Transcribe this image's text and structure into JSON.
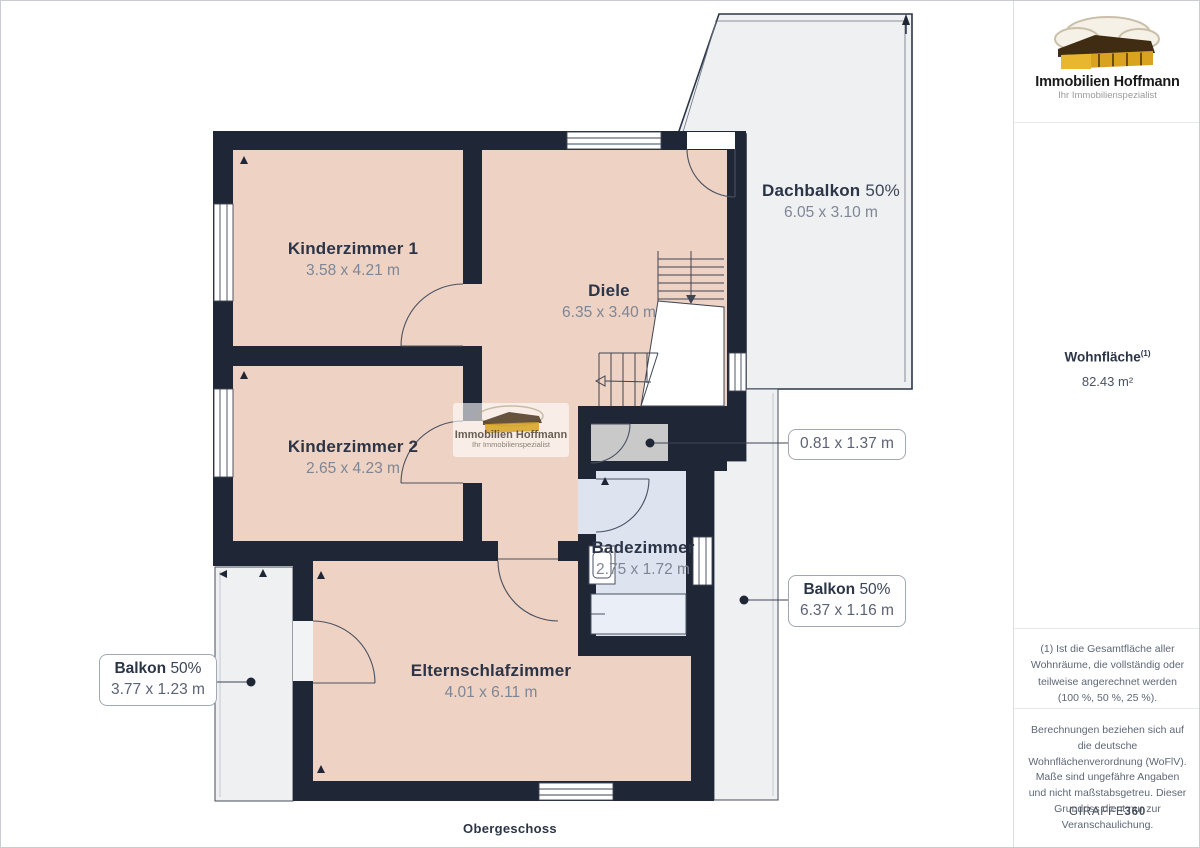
{
  "title": "Obergeschoss",
  "logo": {
    "name": "Immobilien Hoffmann",
    "tagline": "Ihr Immobilienspezialist"
  },
  "watermark": {
    "name": "Immobilien Hoffmann",
    "tagline": "Ihr Immobilienspezialist"
  },
  "sidebar": {
    "area_title": "Wohnfläche",
    "area_sup": "(1)",
    "area_value": "82.43 m²",
    "footnote": "(1) Ist die Gesamtfläche aller Wohnräume, die vollständig oder teilweise angerechnet werden (100 %, 50 %, 25 %).",
    "disclaimer": "Berechnungen beziehen sich auf die deutsche Wohnflächenverordnung (WoFlV). Maße sind ungefähre Angaben und nicht maßstabsgetreu. Dieser Grundriss dient nur zur Veranschaulichung.",
    "brand_light": "GIRAFFE",
    "brand_bold": "360"
  },
  "rooms": [
    {
      "name": "Kinderzimmer 1",
      "dims": "3.58 x 4.21 m"
    },
    {
      "name": "Kinderzimmer 2",
      "dims": "2.65 x 4.23 m"
    },
    {
      "name": "Diele",
      "dims": "6.35 x 3.40 m"
    },
    {
      "name": "Badezimmer",
      "dims": "2.75 x 1.72 m"
    },
    {
      "name": "Elternschlafzimmer",
      "dims": "4.01 x 6.11 m"
    },
    {
      "name": "Dachbalkon",
      "share": "50%",
      "dims": "6.05 x 3.10 m"
    }
  ],
  "callouts": [
    {
      "dims": "0.81 x 1.37 m"
    },
    {
      "name": "Balkon",
      "share": "50%",
      "dims": "6.37 x 1.16 m"
    },
    {
      "name": "Balkon",
      "share": "50%",
      "dims": "3.77 x 1.23 m"
    }
  ],
  "colors": {
    "wall": "#1f2736",
    "floor_pink": "#eed2c4",
    "bath_blue": "#dde4f0",
    "balcony_gray": "#eef0f2",
    "closet_gray": "#c9c9ca",
    "label_navy": "#2c3547",
    "dims_gray": "#7e8695",
    "logo_gold": "#d9a31f"
  }
}
